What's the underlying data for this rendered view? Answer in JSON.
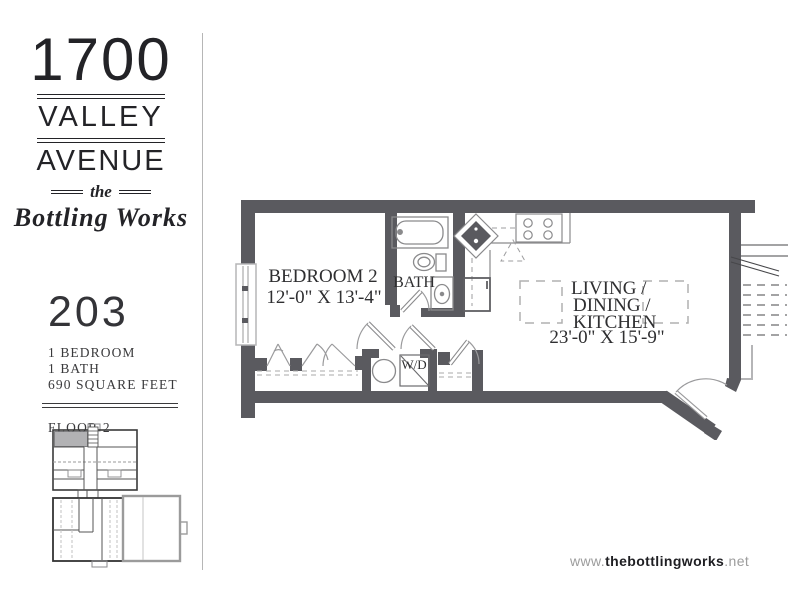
{
  "brand": {
    "line1": "1700",
    "line2": "VALLEY",
    "line3": "AVENUE",
    "script_pre": "the",
    "script_name": "Bottling Works"
  },
  "unit": {
    "number": "203",
    "details": [
      "1 BEDROOM",
      "1 BATH",
      "690 SQUARE FEET"
    ],
    "floor_label": "FLOOR 2"
  },
  "floor_plan": {
    "bedroom_label": "BEDROOM 2",
    "bedroom_dims": "12'-0\" X 13'-4\"",
    "bath_label": "BATH",
    "living_line1": "LIVING /",
    "living_line2": "DINING /",
    "living_line3": "KITCHEN",
    "living_dims": "23'-0\" X 15'-9\"",
    "wd_label": "W/D"
  },
  "footer": {
    "url_prefix": "www.",
    "url_bold": "thebottlingworks",
    "url_suffix": ".net"
  },
  "colors": {
    "wall": "#5a5a5f",
    "fixture_line": "#8a8a8c",
    "light_line": "#b5b5b7",
    "dashed_furniture": "#b0b0b0",
    "logo_text": "#232327",
    "footer_gray": "#9c9c9c",
    "footer_dark": "#1e1e22",
    "unit_highlight": "#b2b2b4"
  }
}
